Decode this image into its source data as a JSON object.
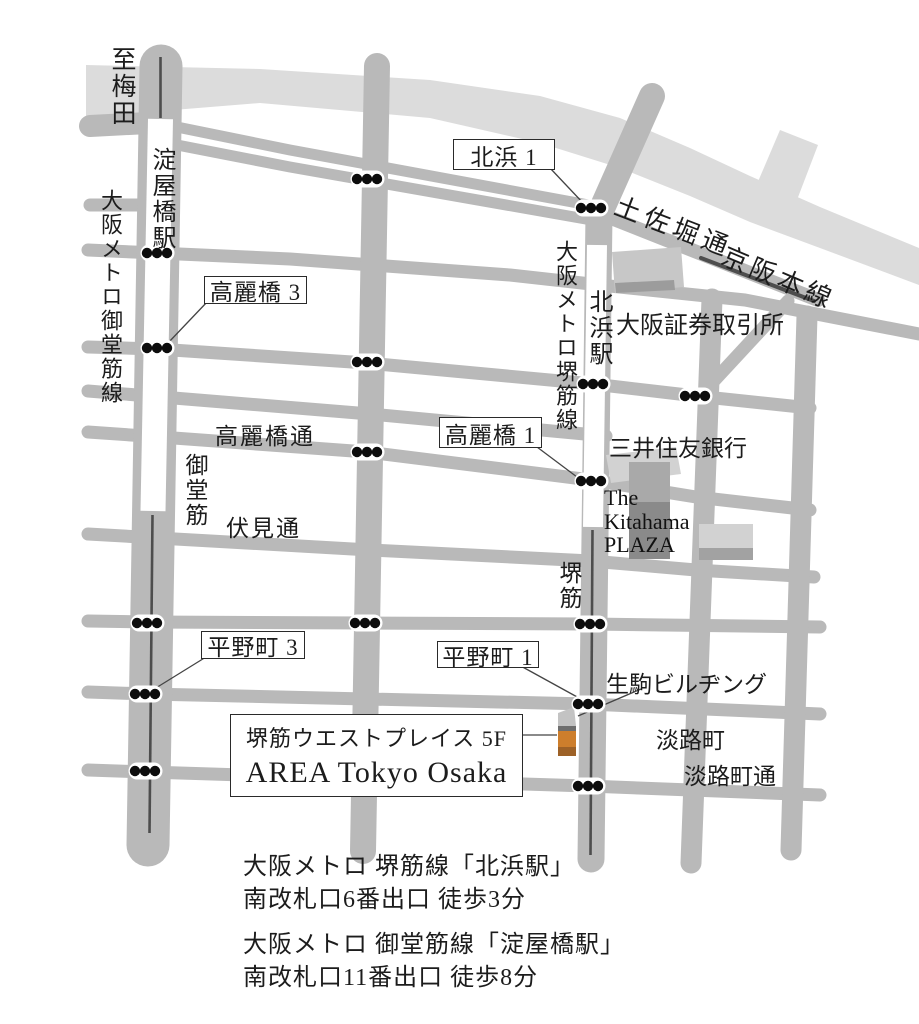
{
  "map": {
    "direction_note": "至梅田",
    "stations": {
      "yodoyabashi": "淀屋橋駅",
      "kitahama": "北浜駅"
    },
    "subway_lines": {
      "midosuji": "大阪メトロ御堂筋線",
      "sakaisuji": "大阪メトロ堺筋線"
    },
    "railways": {
      "keihan": "京阪本線"
    },
    "streets": {
      "midosuji": "御堂筋",
      "sakaisuji": "堺筋",
      "tosabori": "土佐堀通",
      "koraibashi": "高麗橋通",
      "fushimi": "伏見通",
      "awajimachi_dori": "淡路町通"
    },
    "districts": {
      "awajimachi": "淡路町"
    },
    "landmarks": {
      "exchange": "大阪証券取引所",
      "smbc": "三井住友銀行",
      "plaza_line1": "The",
      "plaza_line2": "Kitahama",
      "plaza_line3": "PLAZA",
      "ikoma": "生駒ビルヂング"
    },
    "intersections": {
      "kitahama1": "北浜 1",
      "koraibashi3": "高麗橋 3",
      "koraibashi1": "高麗橋 1",
      "hiranomachi3": "平野町 3",
      "hiranomachi1": "平野町 1"
    },
    "destination": {
      "building": "堺筋ウエストプレイス 5F",
      "name": "AREA Tokyo Osaka"
    }
  },
  "access": {
    "route1_line1": "大阪メトロ 堺筋線「北浜駅」",
    "route1_line2": "南改札口6番出口 徒歩3分",
    "route2_line1": "大阪メトロ 御堂筋線「淀屋橋駅」",
    "route2_line2": "南改札口11番出口 徒歩8分"
  },
  "colors": {
    "road": "#b9b9b9",
    "river": "#dcdcdc",
    "rail_line": "#4d4d4d",
    "destination_marker_orange": "#cd7e2c",
    "destination_marker_brown": "#9d6127",
    "building_dark": "#8a8a8a"
  }
}
